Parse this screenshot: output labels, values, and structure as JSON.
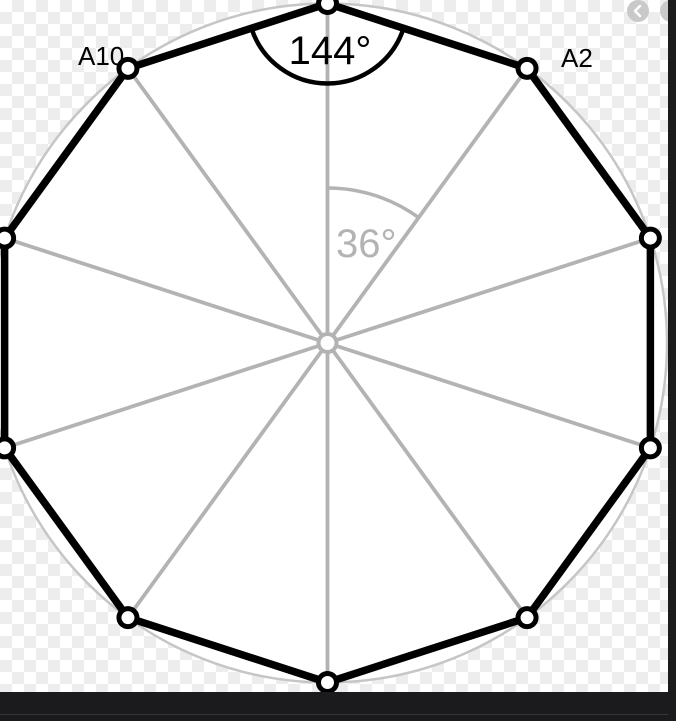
{
  "figure": {
    "type": "regular-decagon-inscribed-in-circle",
    "labels": {
      "vertex_top_left": "A10",
      "vertex_top_right": "A2",
      "interior_angle": "144°",
      "central_angle": "36°"
    },
    "colors": {
      "polygon_stroke": "#000000",
      "radius_lines": "#b3b3b3",
      "circumcircle_stroke": "#c6c6c6",
      "gray_label": "#b3b3b3",
      "checker_gray": "#ededed",
      "dark_panel": "#1b1b1e",
      "nav_button_gray": "#c9c9c9"
    }
  },
  "nav": {
    "prev_icon": "chevron-left-icon",
    "next_icon": "chevron-right-icon"
  }
}
